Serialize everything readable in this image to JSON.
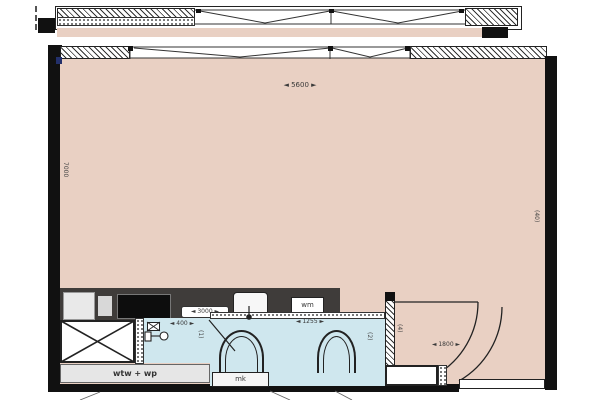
{
  "title": "apartment floor plan",
  "colors": {
    "floor": "#e9d0c3",
    "wet_room": "#cfe7ee",
    "counter": "#3f3c3a",
    "wall": "#111111",
    "line": "#222222"
  },
  "rooms": {
    "main": {
      "width_dim": "◄ 5600 ►",
      "depth_dim": "7000",
      "area_tag": "(40)"
    },
    "kitchen": {
      "counter_dim": "◄ 3000 ►",
      "washer_label": "wm"
    },
    "toilet": {
      "width_dim": "◄ 400 ►",
      "area_tag": "(1)"
    },
    "bathroom": {
      "width_dim": "◄ 1255 ►",
      "area_tag": "(2)",
      "meter_box_label": "mk"
    },
    "hall": {
      "width_dim": "◄ 1800 ►",
      "area_tag": "(4)"
    },
    "utility": {
      "label": "wtw + wp"
    }
  }
}
